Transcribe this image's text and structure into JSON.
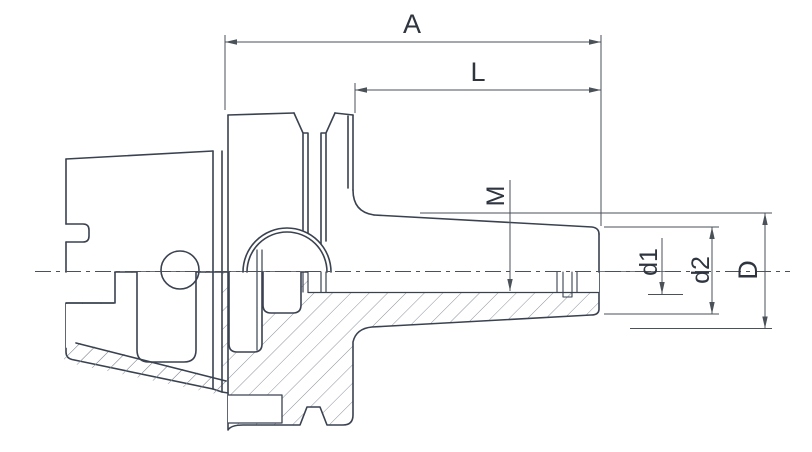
{
  "drawing": {
    "type": "technical-drawing",
    "subject": "shrink-fit tool holder, half section view with hatching",
    "labels": {
      "A": "A",
      "L": "L",
      "M": "M",
      "d1": "d1",
      "d2": "d2",
      "D": "D"
    },
    "colors": {
      "outline": "#3a4250",
      "dimension": "#4a5158",
      "hatch": "#8b929c",
      "text": "#2e353f",
      "background": "#ffffff"
    }
  }
}
